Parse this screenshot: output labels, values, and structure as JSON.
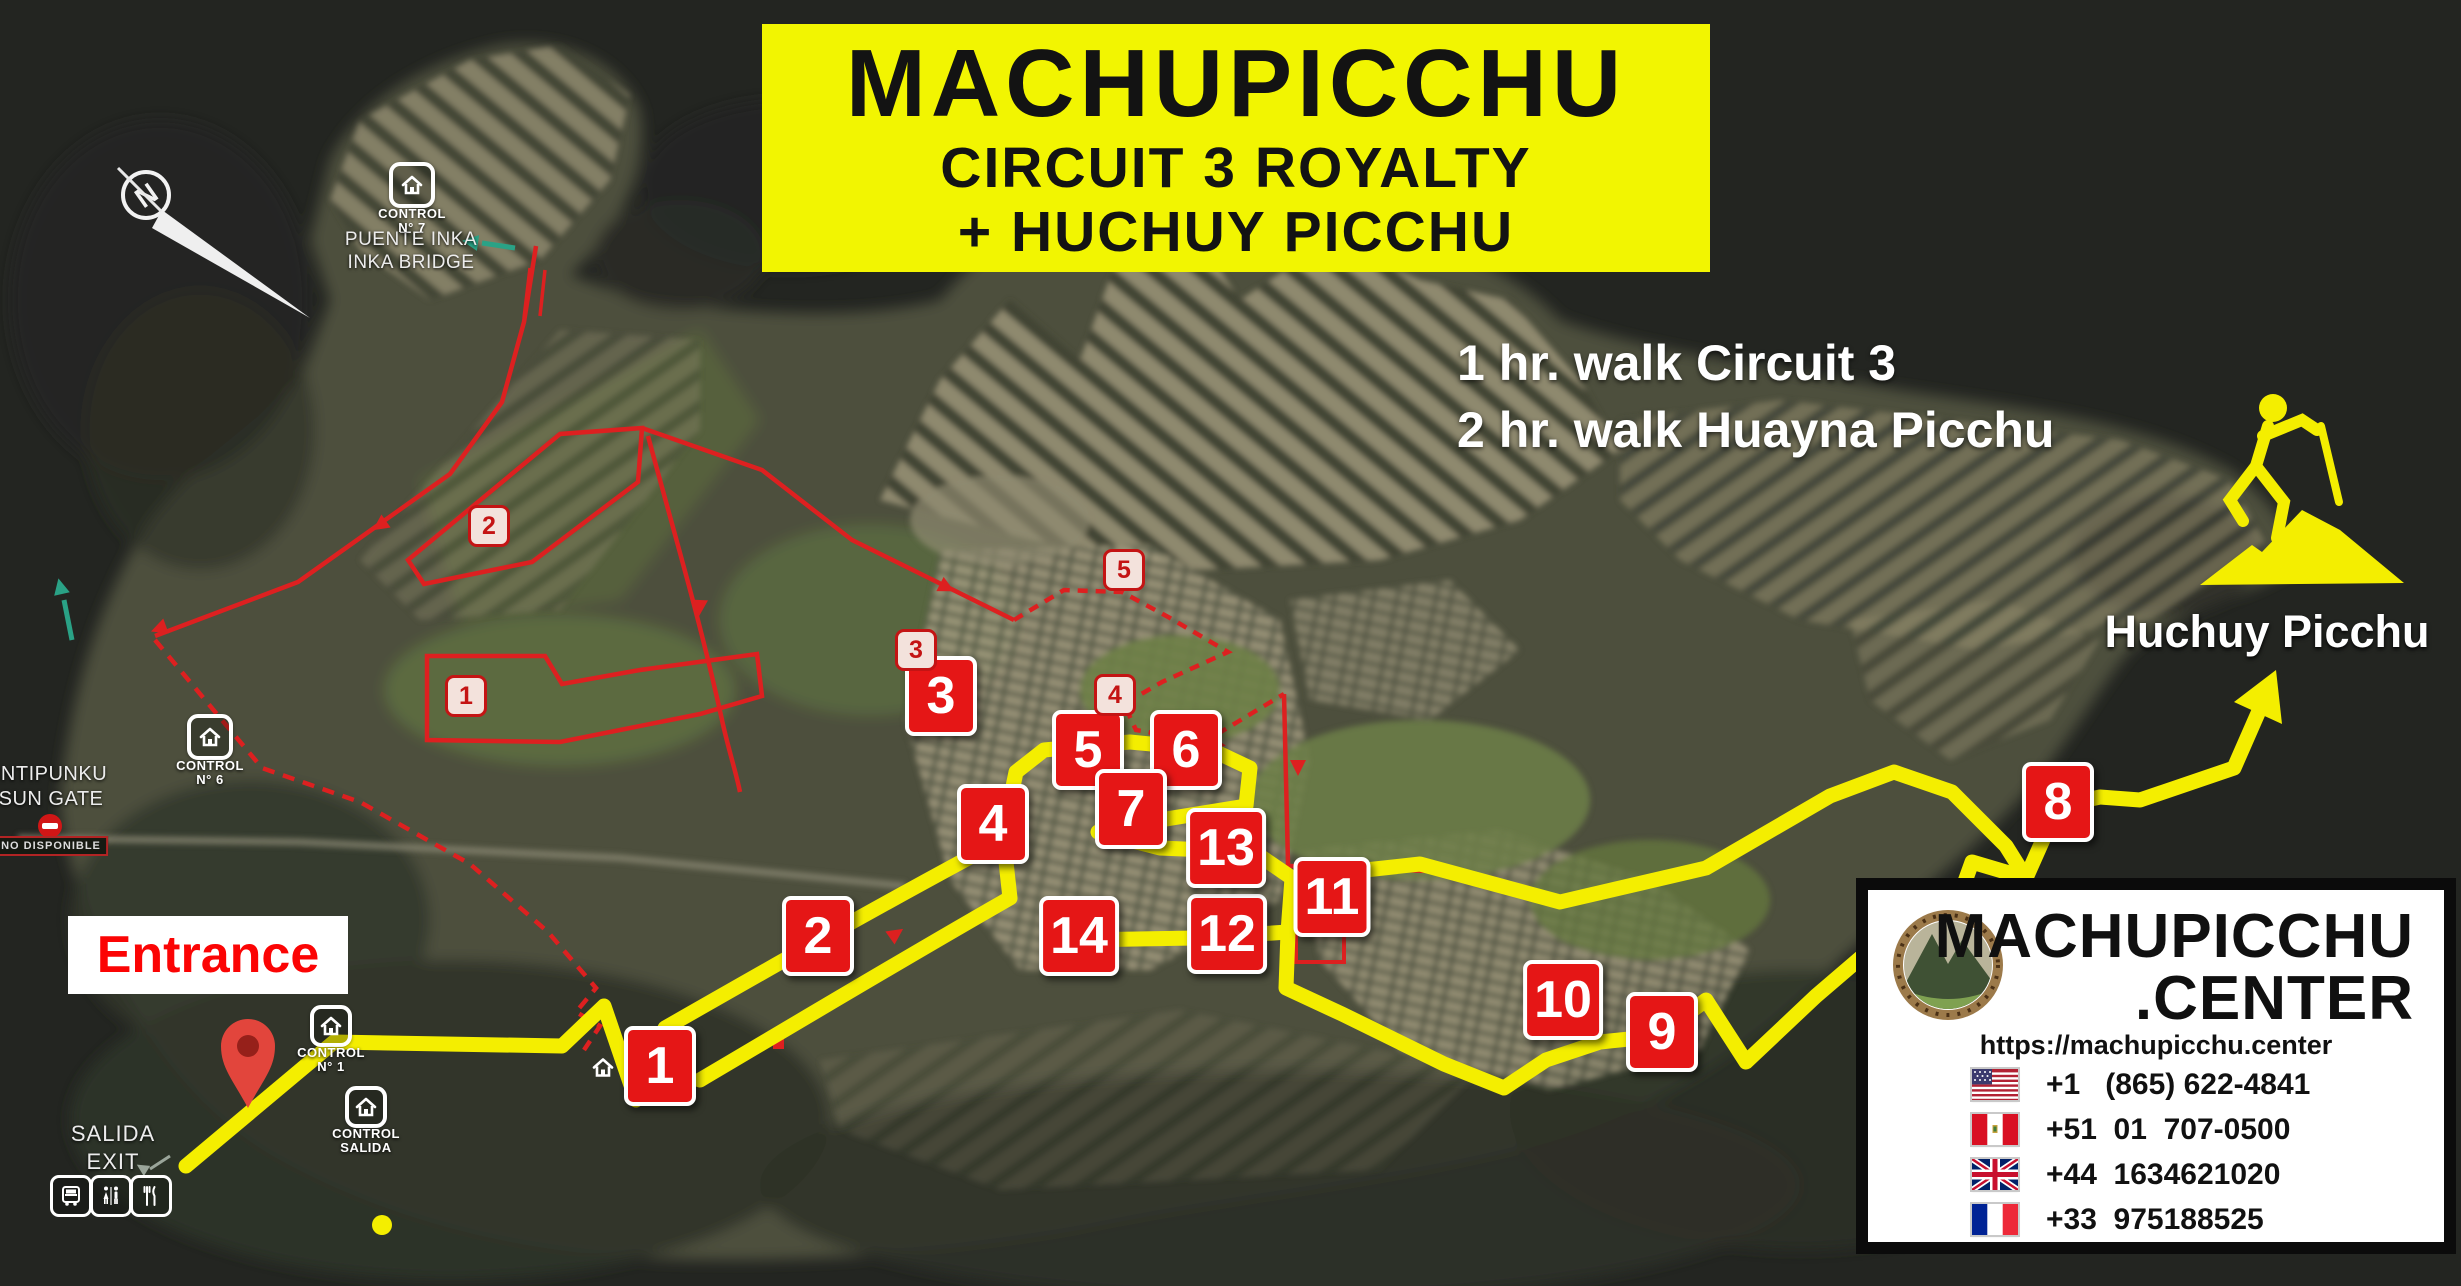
{
  "map_title": {
    "line1": "MACHUPICCHU",
    "line2": "CIRCUIT 3 ROYALTY",
    "line3": "+ HUCHUY PICCHU"
  },
  "walk_info": {
    "line1": "1 hr. walk Circuit 3",
    "line2": "2 hr. walk Huayna Picchu"
  },
  "labels": {
    "entrance": "Entrance",
    "salida": "SALIDA",
    "exit": "EXIT",
    "intipunku": "INTIPUNKU",
    "sun_gate": "SUN GATE",
    "no_disponible": "NO DISPONIBLE",
    "puente_inka": "PUENTE INKA",
    "inka_bridge": "INKA BRIDGE",
    "huchuy_picchu": "Huchuy Picchu",
    "compass_north": "N"
  },
  "route_markers": [
    {
      "label": "1",
      "x": 660,
      "y": 1066
    },
    {
      "label": "2",
      "x": 818,
      "y": 936
    },
    {
      "label": "3",
      "x": 941,
      "y": 696
    },
    {
      "label": "4",
      "x": 993,
      "y": 824
    },
    {
      "label": "5",
      "x": 1088,
      "y": 750
    },
    {
      "label": "6",
      "x": 1186,
      "y": 750
    },
    {
      "label": "7",
      "x": 1131,
      "y": 809
    },
    {
      "label": "8",
      "x": 2058,
      "y": 802
    },
    {
      "label": "9",
      "x": 1662,
      "y": 1032
    },
    {
      "label": "10",
      "x": 1563,
      "y": 1000
    },
    {
      "label": "11",
      "x": 1332,
      "y": 897
    },
    {
      "label": "12",
      "x": 1227,
      "y": 934
    },
    {
      "label": "13",
      "x": 1226,
      "y": 848
    },
    {
      "label": "14",
      "x": 1079,
      "y": 936
    }
  ],
  "circuit_point_markers": [
    {
      "label": "1",
      "x": 466,
      "y": 696
    },
    {
      "label": "2",
      "x": 489,
      "y": 526
    },
    {
      "label": "3",
      "x": 916,
      "y": 650
    },
    {
      "label": "4",
      "x": 1115,
      "y": 695
    },
    {
      "label": "5",
      "x": 1124,
      "y": 570
    }
  ],
  "control_points": [
    {
      "id": "control-7",
      "line1": "CONTROL",
      "line2": "N° 7",
      "x": 412,
      "y": 185,
      "size": 38
    },
    {
      "id": "control-6",
      "line1": "CONTROL",
      "line2": "N° 6",
      "x": 210,
      "y": 737,
      "size": 38
    },
    {
      "id": "control-1",
      "line1": "CONTROL",
      "line2": "N° 1",
      "x": 331,
      "y": 1026,
      "size": 34
    },
    {
      "id": "control-salida",
      "line1": "CONTROL",
      "line2": "SALIDA",
      "x": 366,
      "y": 1107,
      "size": 34
    }
  ],
  "plain_house": {
    "x": 603,
    "y": 1070
  },
  "facilities": [
    {
      "id": "bus",
      "x": 71,
      "y": 1196
    },
    {
      "id": "restrooms",
      "x": 111,
      "y": 1196
    },
    {
      "id": "restaurant",
      "x": 151,
      "y": 1196
    }
  ],
  "info_card": {
    "brand_line1": "MACHUPICCHU",
    "brand_line2": ".CENTER",
    "url": "https://machupicchu.center",
    "phones": [
      {
        "flag": "us",
        "number": "+1   (865) 622-4841"
      },
      {
        "flag": "pe",
        "number": "+51  01  707-0500"
      },
      {
        "flag": "gb",
        "number": "+44  1634621020"
      },
      {
        "flag": "fr",
        "number": "+33  975188525"
      }
    ]
  },
  "colors": {
    "route_yellow": "#f4ee00",
    "marker_red": "#e51616",
    "entrance_red": "#fb0404",
    "title_bg": "#f2f501",
    "land_olive": "#4d4f3c",
    "dark_bg": "#232521",
    "teal_arrow": "#2aa286"
  }
}
